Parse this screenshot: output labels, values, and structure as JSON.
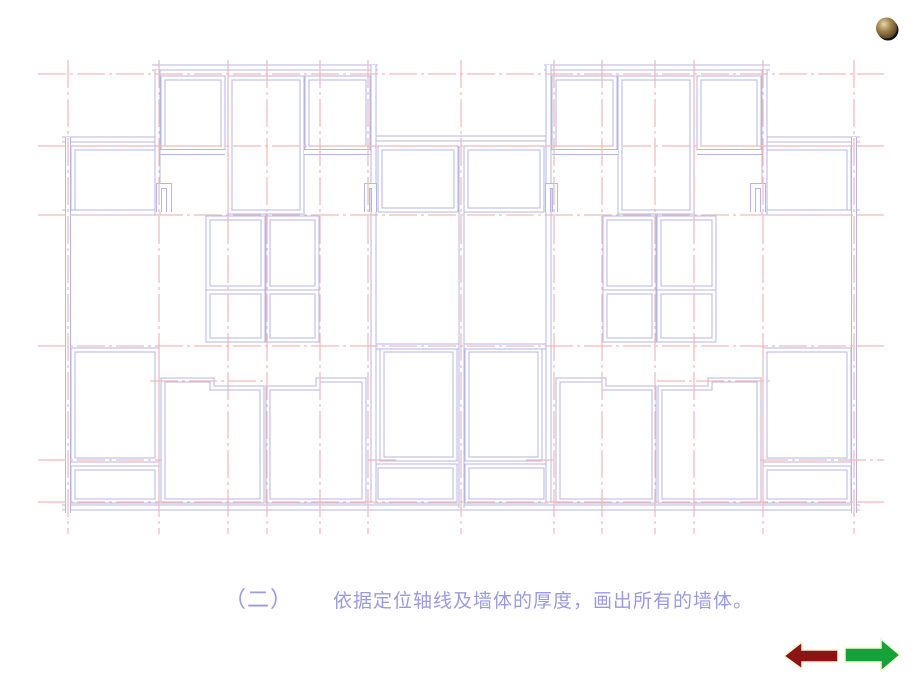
{
  "slide": {
    "width": 920,
    "height": 690,
    "background": "#ffffff"
  },
  "caption": {
    "part1": "（二）",
    "part2": "依据定位轴线及墙体的厚度，画出所有的墙体。",
    "color": "#9a9ae0"
  },
  "nav": {
    "prev_label": "previous-slide-arrow",
    "next_label": "next-slide-arrow",
    "prev_color": "#8c1414",
    "next_color": "#16a238",
    "outline_color": "#f8f3d4"
  },
  "decoration": {
    "sphere_colors": {
      "highlight": "#e8d6ac",
      "mid": "#a1834e",
      "dark": "#4a3820",
      "shadow": "#17100a"
    }
  },
  "floor_plan": {
    "description": "symmetric two-unit apartment floor plan, wall-drawing stage",
    "axis_color": "#f5b6b6",
    "wall_color": "#b5b5e6",
    "line_bg": "#ffffff",
    "axes": [
      [
        38,
        74,
        884,
        74
      ],
      [
        38,
        146,
        884,
        146
      ],
      [
        38,
        215,
        884,
        215
      ],
      [
        38,
        346,
        884,
        346
      ],
      [
        150,
        381,
        265,
        381
      ],
      [
        657,
        381,
        772,
        381
      ],
      [
        38,
        460,
        162,
        460
      ],
      [
        368,
        460,
        396,
        460
      ],
      [
        526,
        460,
        554,
        460
      ],
      [
        760,
        460,
        884,
        460
      ],
      [
        38,
        502,
        884,
        502
      ],
      [
        68,
        60,
        68,
        534
      ],
      [
        159,
        60,
        159,
        534
      ],
      [
        228,
        60,
        228,
        534
      ],
      [
        267,
        60,
        267,
        534
      ],
      [
        320,
        60,
        320,
        534
      ],
      [
        368,
        60,
        368,
        534
      ],
      [
        461,
        60,
        461,
        534
      ],
      [
        554,
        60,
        554,
        534
      ],
      [
        602,
        60,
        602,
        534
      ],
      [
        655,
        60,
        655,
        534
      ],
      [
        694,
        60,
        694,
        534
      ],
      [
        763,
        60,
        763,
        534
      ],
      [
        854,
        60,
        854,
        534
      ]
    ],
    "wall_lines": [
      [
        62,
        139.5,
        158,
        139.5
      ],
      [
        152,
        67.5,
        378,
        67.5
      ],
      [
        157,
        152,
        225,
        152
      ],
      [
        304,
        152,
        370,
        152
      ],
      [
        62,
        212.5,
        160,
        212.5
      ],
      [
        374,
        138.5,
        548,
        138.5
      ],
      [
        374,
        346.5,
        548,
        346.5
      ],
      [
        62,
        507.5,
        860,
        507.5
      ],
      [
        764,
        139.5,
        860,
        139.5
      ],
      [
        544,
        67.5,
        770,
        67.5
      ],
      [
        697,
        152,
        765,
        152
      ],
      [
        552,
        152,
        618,
        152
      ],
      [
        762,
        212.5,
        860,
        212.5
      ],
      [
        68,
        137,
        68,
        513
      ],
      [
        157.5,
        70,
        157.5,
        215
      ],
      [
        373.5,
        65,
        373.5,
        503
      ],
      [
        461.5,
        146,
        461.5,
        508
      ],
      [
        854,
        137,
        854,
        513
      ],
      [
        764.5,
        70,
        764.5,
        215
      ],
      [
        548.5,
        65,
        548.5,
        503
      ]
    ],
    "wall_paths": [
      "M159,212 L159,186 L169,186 L169,212",
      "M367,212 L367,186 L374,186 L374,212",
      "M763,212 L763,186 L753,186 L753,212",
      "M555,212 L555,186 L548,186 L548,212"
    ],
    "rooms": [
      [
        163,
        78,
        60,
        70
      ],
      [
        230,
        78,
        72,
        134
      ],
      [
        307,
        78,
        61,
        70
      ],
      [
        73,
        148,
        84,
        64
      ],
      [
        380,
        148,
        76,
        62
      ],
      [
        208,
        218,
        55,
        70
      ],
      [
        268,
        218,
        49,
        70
      ],
      [
        208,
        292,
        55,
        48
      ],
      [
        268,
        292,
        49,
        48
      ],
      [
        73,
        350,
        84,
        110
      ],
      [
        73,
        468,
        84,
        33
      ],
      [
        382,
        350,
        73,
        109
      ],
      [
        376,
        466,
        79,
        35
      ],
      [
        699,
        78,
        60,
        70
      ],
      [
        620,
        78,
        72,
        134
      ],
      [
        554,
        78,
        61,
        70
      ],
      [
        765,
        148,
        84,
        64
      ],
      [
        466,
        148,
        76,
        62
      ],
      [
        659,
        218,
        55,
        70
      ],
      [
        605,
        218,
        49,
        70
      ],
      [
        659,
        292,
        55,
        48
      ],
      [
        605,
        292,
        49,
        48
      ],
      [
        765,
        350,
        84,
        110
      ],
      [
        765,
        468,
        84,
        33
      ],
      [
        467,
        350,
        73,
        109
      ],
      [
        467,
        466,
        79,
        35
      ]
    ],
    "room_polys": [
      "163,380 212,380 212,388 262,388 262,501 163,501",
      "268,388 318,388 318,380 364,380 364,501 268,501",
      "759,380 710,380 710,388 660,388 660,501 759,501",
      "654,388 604,388 604,380 558,380 558,501 654,501"
    ]
  }
}
